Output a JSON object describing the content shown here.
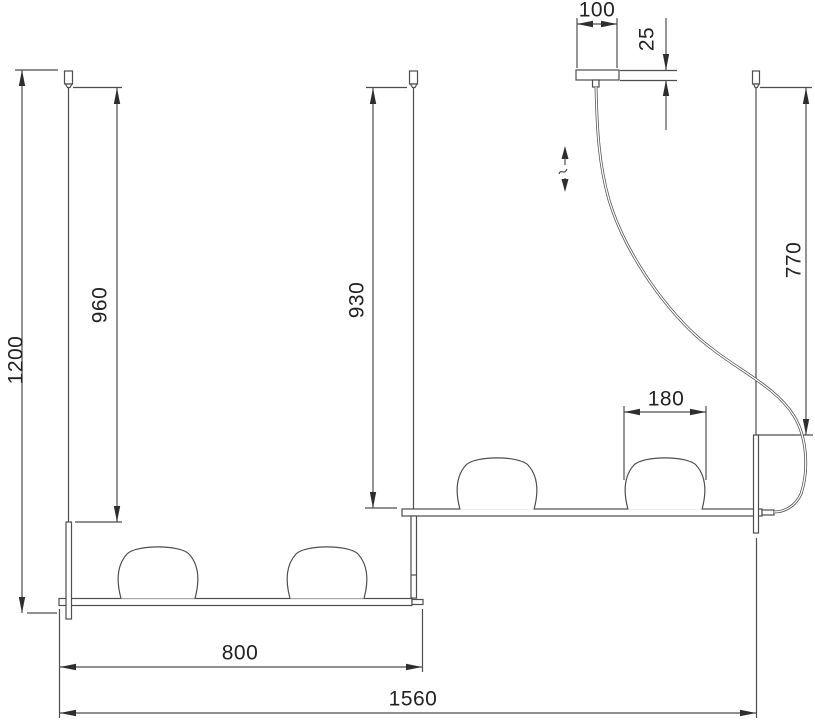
{
  "drawing": {
    "units": "mm",
    "colors": {
      "background": "#ffffff",
      "line": "#4e4e4e",
      "arrow": "#2e2e2e",
      "text": "#222222"
    },
    "dimensions": {
      "overall_height": {
        "value": "1200",
        "orientation": "vertical"
      },
      "left_rod_drop": {
        "value": "960",
        "orientation": "vertical"
      },
      "middle_rod_drop": {
        "value": "930",
        "orientation": "vertical"
      },
      "cable_rod_drop": {
        "value": "770",
        "orientation": "vertical"
      },
      "canopy_width": {
        "value": "100",
        "orientation": "horizontal"
      },
      "canopy_height": {
        "value": "25",
        "orientation": "vertical"
      },
      "shade_diameter": {
        "value": "180",
        "orientation": "horizontal"
      },
      "lower_bar_length": {
        "value": "800",
        "orientation": "horizontal"
      },
      "overall_length": {
        "value": "1560",
        "orientation": "horizontal"
      }
    },
    "symbols": {
      "height_adjustable": "double-arrow-with-break"
    }
  }
}
